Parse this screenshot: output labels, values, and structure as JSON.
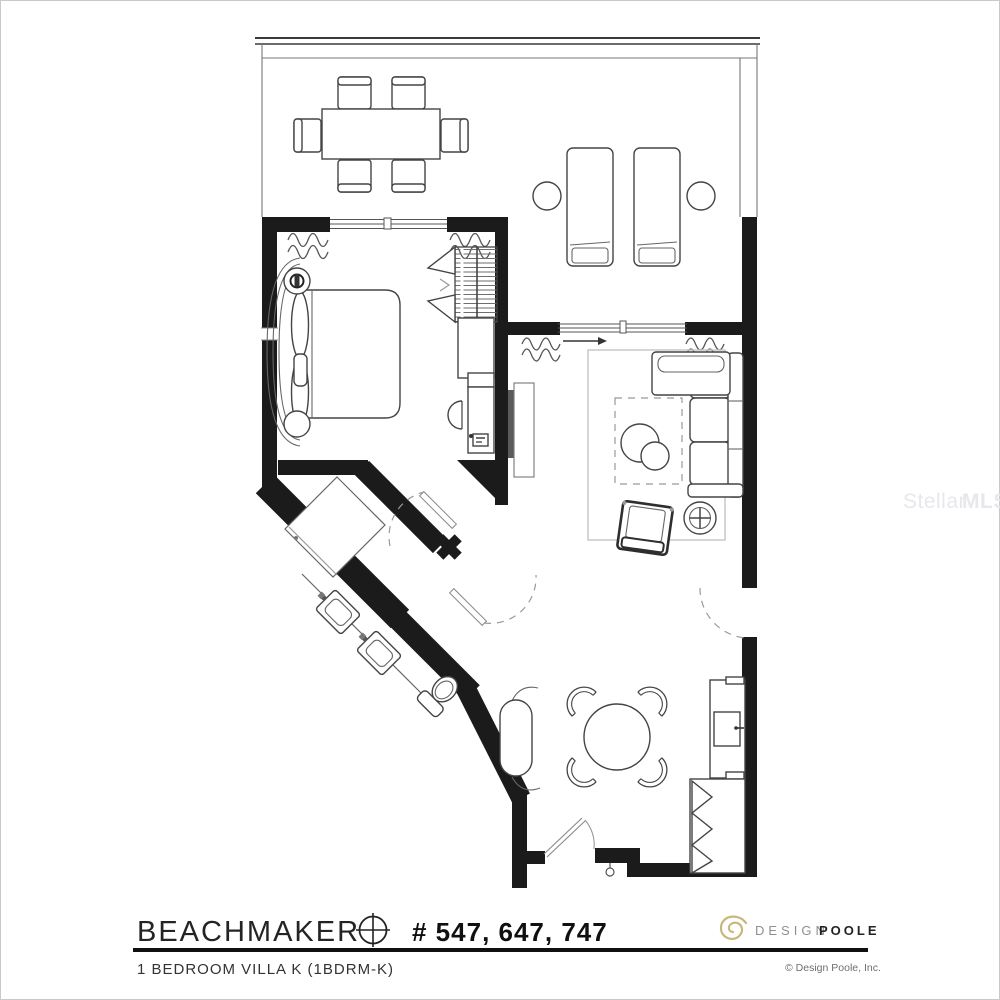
{
  "footer": {
    "property_name": "BEACHMAKER",
    "unit_numbers": "# 547, 647, 747",
    "unit_type": "1 BEDROOM VILLA K (1BDRM-K)"
  },
  "branding": {
    "design": "DESIGN",
    "poole": "POOLE",
    "copyright": "© Design Poole, Inc."
  },
  "watermark": {
    "stellar": "Stellar",
    "mls": "MLS"
  },
  "colors": {
    "wall": "#1b1b1b",
    "brand_gold": "#c8b77a",
    "watermark": "#e7e7ec"
  }
}
